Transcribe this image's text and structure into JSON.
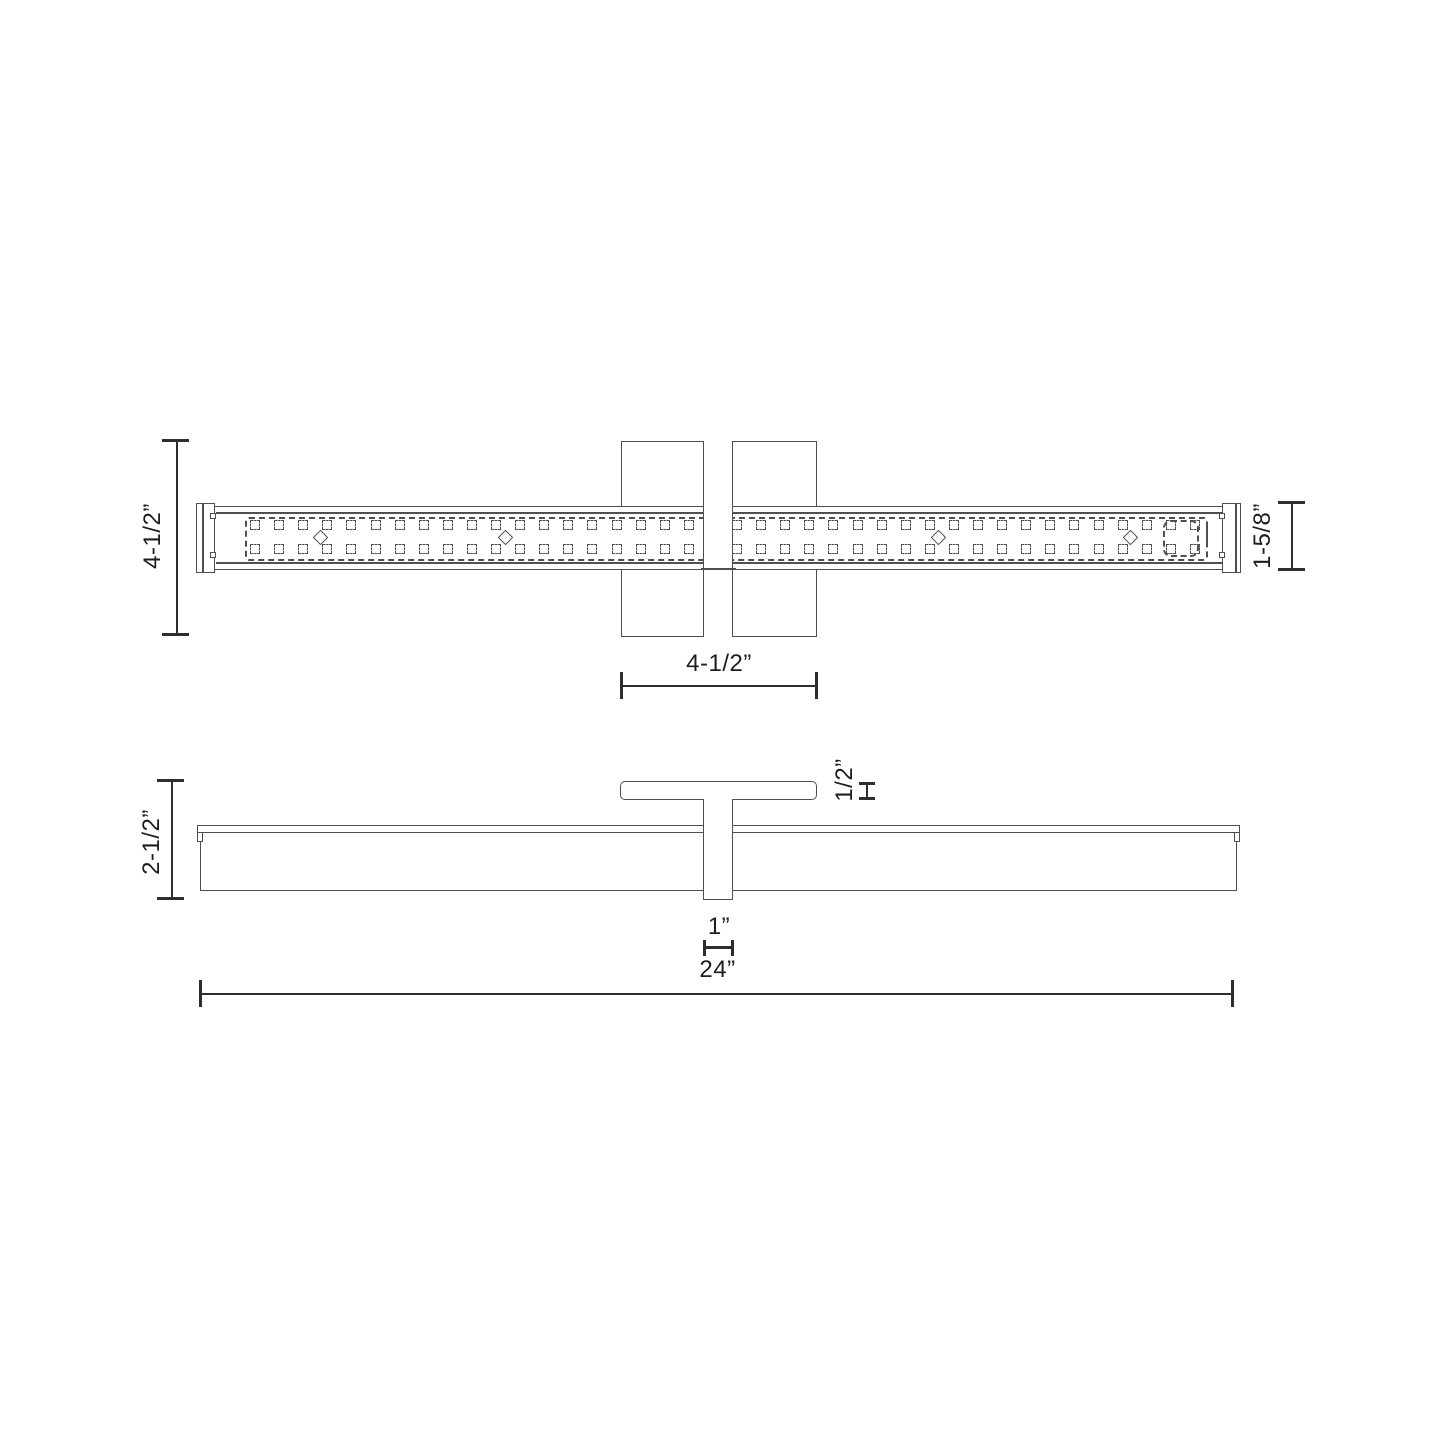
{
  "drawing": {
    "kind": "technical-dimension-diagram",
    "subject": "Linear LED bath vanity light — plan view with mounting backplate and side profile view",
    "colors": {
      "background": "#ffffff",
      "line": "#4f4f4f",
      "dim_line": "#2e2e2e",
      "text": "#1e1e1e"
    },
    "top_view": {
      "labels": {
        "overall_height": "4-1/2”",
        "bar_height": "1-5/8”",
        "backplate_width": "4-1/2”"
      },
      "led_pattern": {
        "columns": 40,
        "rows": 2,
        "start_x": 255,
        "pitch_x": 24.1,
        "row_y": [
          520,
          544
        ],
        "diamond_x": [
          320,
          505,
          938,
          1130
        ],
        "diamond_y": 537
      }
    },
    "side_view": {
      "labels": {
        "overall_depth": "2-1/2”",
        "canopy_thickness": "1/2”",
        "stem_width": "1”",
        "overall_width": "24”"
      }
    }
  }
}
